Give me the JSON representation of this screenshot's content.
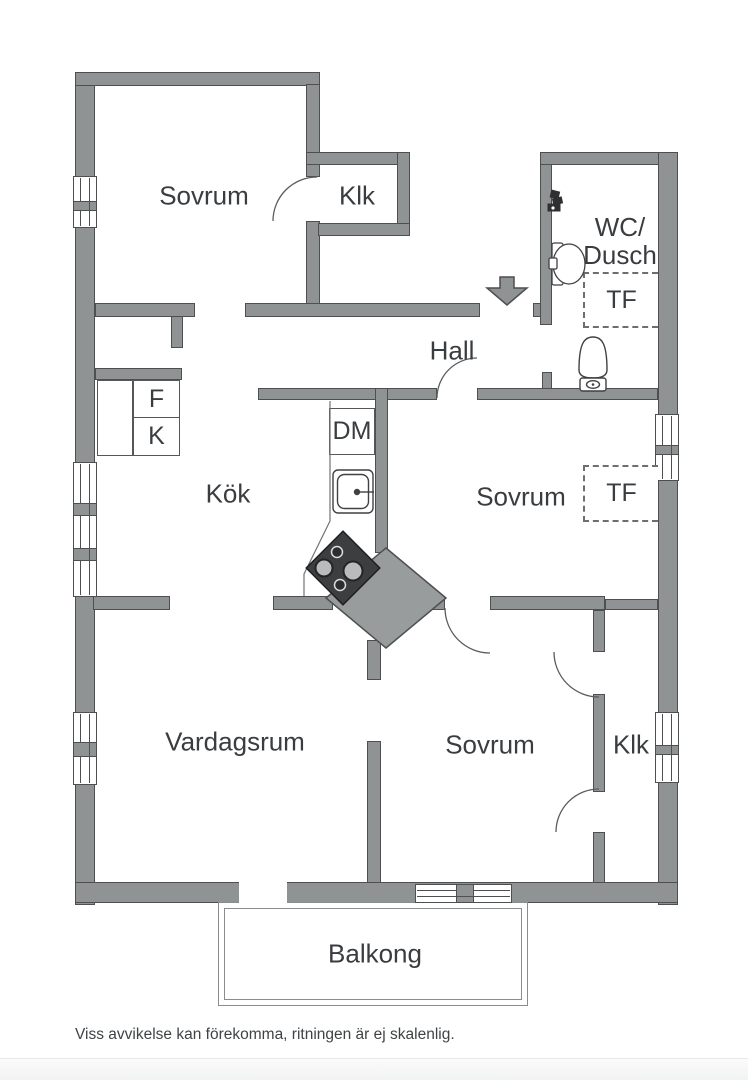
{
  "rooms": {
    "sovrum_top": {
      "label": "Sovrum"
    },
    "klk_top": {
      "label": "Klk"
    },
    "wc_dusch": {
      "line1": "WC/",
      "line2": "Dusch"
    },
    "hall": {
      "label": "Hall"
    },
    "kok": {
      "label": "Kök"
    },
    "sovrum_mid": {
      "label": "Sovrum"
    },
    "vardagsrum": {
      "label": "Vardagsrum"
    },
    "sovrum_bottom": {
      "label": "Sovrum"
    },
    "klk_bottom": {
      "label": "Klk"
    },
    "balkong": {
      "label": "Balkong"
    }
  },
  "labels": {
    "fridge": "F",
    "freezer": "K",
    "dishwasher": "DM",
    "cabinet_tf": "TF"
  },
  "fixtures": [
    "entrance-arrow",
    "shower-mixer",
    "wash-basin",
    "toilet",
    "kitchen-sink",
    "stove",
    "ventilation-shaft",
    "door-swing",
    "window"
  ],
  "footer": {
    "disclaimer": "Viss avvikelse kan förekomma, ritningen är ej skalenlig."
  },
  "colors": {
    "wall_fill": "#8f9394",
    "wall_outline": "#4d4f50",
    "shaft_fill": "#989c9d",
    "label_text": "#3a3d40",
    "fixture_stroke": "#3f4142",
    "dashed_box": "#6c6f70"
  }
}
